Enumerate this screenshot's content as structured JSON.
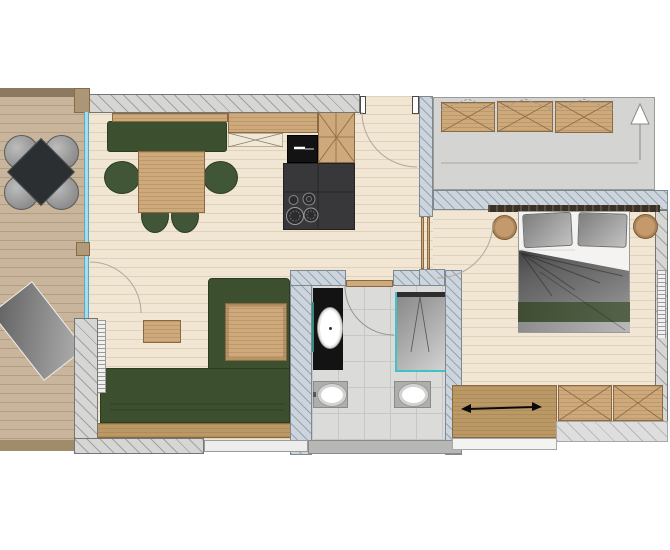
{
  "meta": {
    "type": "architectural-floor-plan",
    "description": "Top-down apartment floor plan: balcony with outdoor dining set and sun lounger (left), open living-dining room with kitchen block and corner sofa (center), bathroom with shower, vanity, WC and bidet (center), double bedroom (right), entrance hall with wardrobes under sloped roof (top right).",
    "visible_text": []
  },
  "colors": {
    "wall_ext": "#d6d6d4",
    "wall_ext_border": "#757573",
    "wall_part": "#ccd5dd",
    "wall_part_border": "#7e8890",
    "floor": "#f1e5d3",
    "floor_line": "#e0d1b8",
    "deck": "#c8b59b",
    "deck_line": "#b19e84",
    "railing": "#8c7a60",
    "hall_floor": "#d4d4d2",
    "wood": "#cda97c",
    "wood_dark": "#bb9967",
    "wood_border": "#8a6a42",
    "green": "#3c5030",
    "green_border": "#2b3c20",
    "black_unit": "#131313",
    "charcoal": "#38383b",
    "glass_blue": "#a8dcec",
    "glass_border": "#5aa8c0",
    "shower_teal": "#3fc3c7",
    "mirror_teal": "#2f8f78",
    "bath_floor": "#dbdbd9",
    "tile_line": "#c7c7c5",
    "fixture_gray": "#aeaeac",
    "bed_green": "#485640",
    "metal_gray": "#9e9e9e",
    "arc": "#b0a89e"
  },
  "rooms": {
    "balcony": {
      "items": [
        "outdoor-dining-table",
        "outdoor-chair x4",
        "sun-lounger",
        "railing",
        "glass-sliding-front"
      ]
    },
    "living_dining": {
      "items": [
        "dining-bench",
        "dining-table",
        "dining-chair x4",
        "wall-shelf",
        "corner-sofa",
        "sofa-corner-table",
        "coffee-table",
        "radiator",
        "balcony-door",
        "entrance-door"
      ]
    },
    "kitchen": {
      "items": [
        "upper-cabinet",
        "worktop",
        "sink-unit",
        "tall-cabinet",
        "kitchen-block",
        "cooktop-4-burners"
      ]
    },
    "bathroom": {
      "items": [
        "vanity-with-sink",
        "mirror",
        "shower",
        "toilet",
        "bidet",
        "door"
      ]
    },
    "bedroom": {
      "items": [
        "double-bed",
        "pillow x2",
        "duvet",
        "headboard",
        "nightstand x2",
        "dresser-with-sliding-door",
        "wardrobe x2",
        "radiator",
        "door"
      ]
    },
    "hall": {
      "items": [
        "wardrobe x3",
        "entrance-direction-arrow",
        "sloped-roof-floor-area"
      ]
    }
  }
}
